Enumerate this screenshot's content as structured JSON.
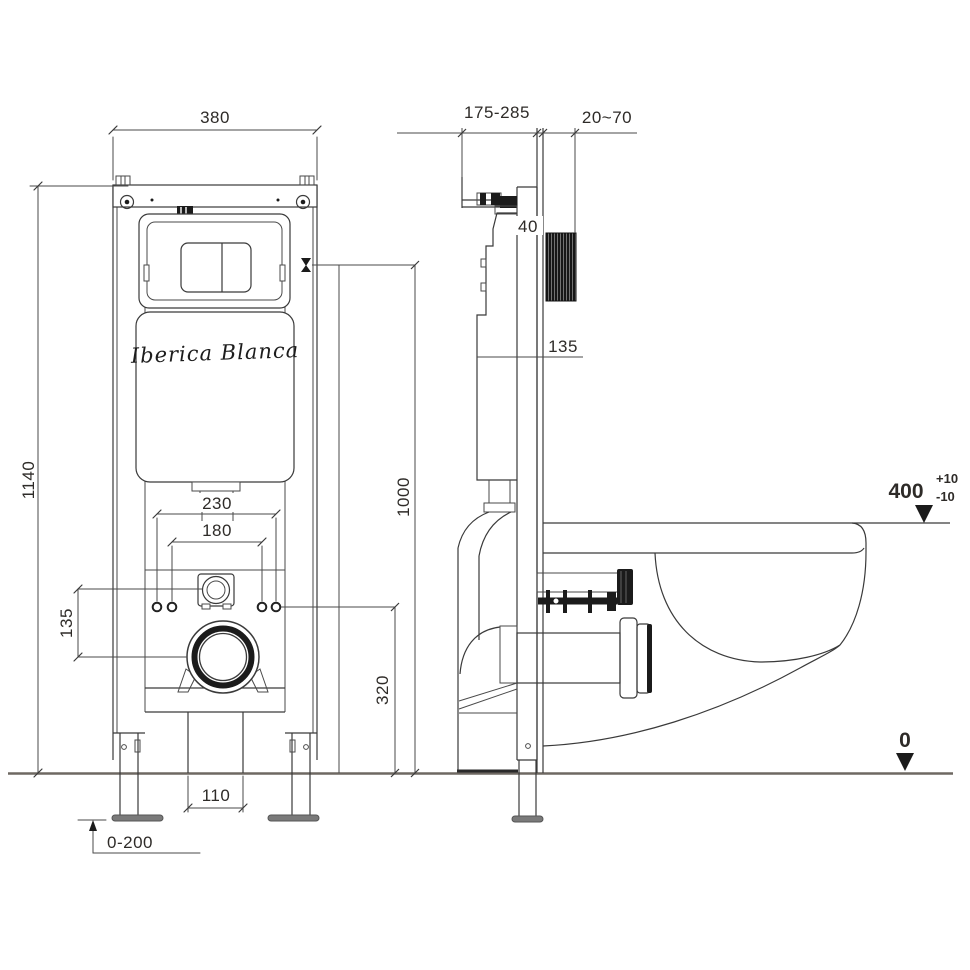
{
  "drawing": {
    "type": "wall-hung toilet concealed cistern frame installation drawing",
    "views": {
      "front": "front view",
      "side": "side view"
    }
  },
  "brand": {
    "logo_text": "Iberica Blanca"
  },
  "front_view": {
    "dim_width_top": "380",
    "dim_height": "1140",
    "dim_opening_width": "230",
    "dim_bolt_spacing": "180",
    "dim_inlet_offset": "135",
    "dim_outlet_width": "110",
    "dim_leg_adjust": "0-200"
  },
  "center_dims": {
    "dim_flush_height": "1000",
    "dim_bolt_height": "320"
  },
  "side_view": {
    "dim_depth_range": "175-285",
    "dim_wall_finish": "20~70",
    "dim_rail_depth": "40",
    "dim_shaft_height": "135",
    "dim_bowl_height": "400",
    "tol_plus": "+10",
    "tol_minus": "-10",
    "floor_level": "0"
  },
  "colors": {
    "line": "#3a3a3a",
    "floor": "#6e6862",
    "dark_parts": "#1b1b1b",
    "foot_plate": "#7a7a7a",
    "background": "#ffffff"
  }
}
